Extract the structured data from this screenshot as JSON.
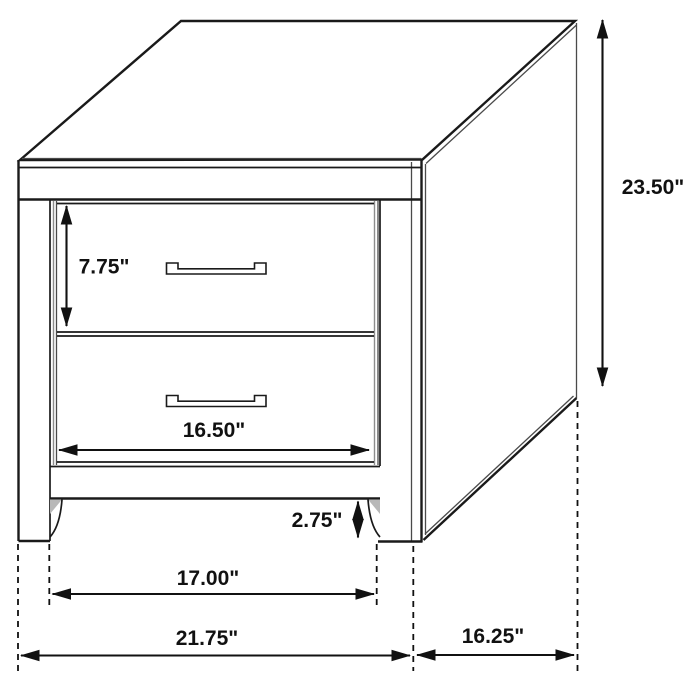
{
  "diagram": {
    "subject": "2-drawer nightstand dimension drawing",
    "background_color": "#ffffff",
    "line_color": "#1a1a1a",
    "text_color": "#111111",
    "labels": {
      "drawer_height": "7.75\"",
      "overall_height": "23.50\"",
      "drawer_width": "16.50\"",
      "base_clearance": "2.75\"",
      "leg_span": "17.00\"",
      "overall_width": "21.75\"",
      "overall_depth": "16.25\""
    }
  }
}
